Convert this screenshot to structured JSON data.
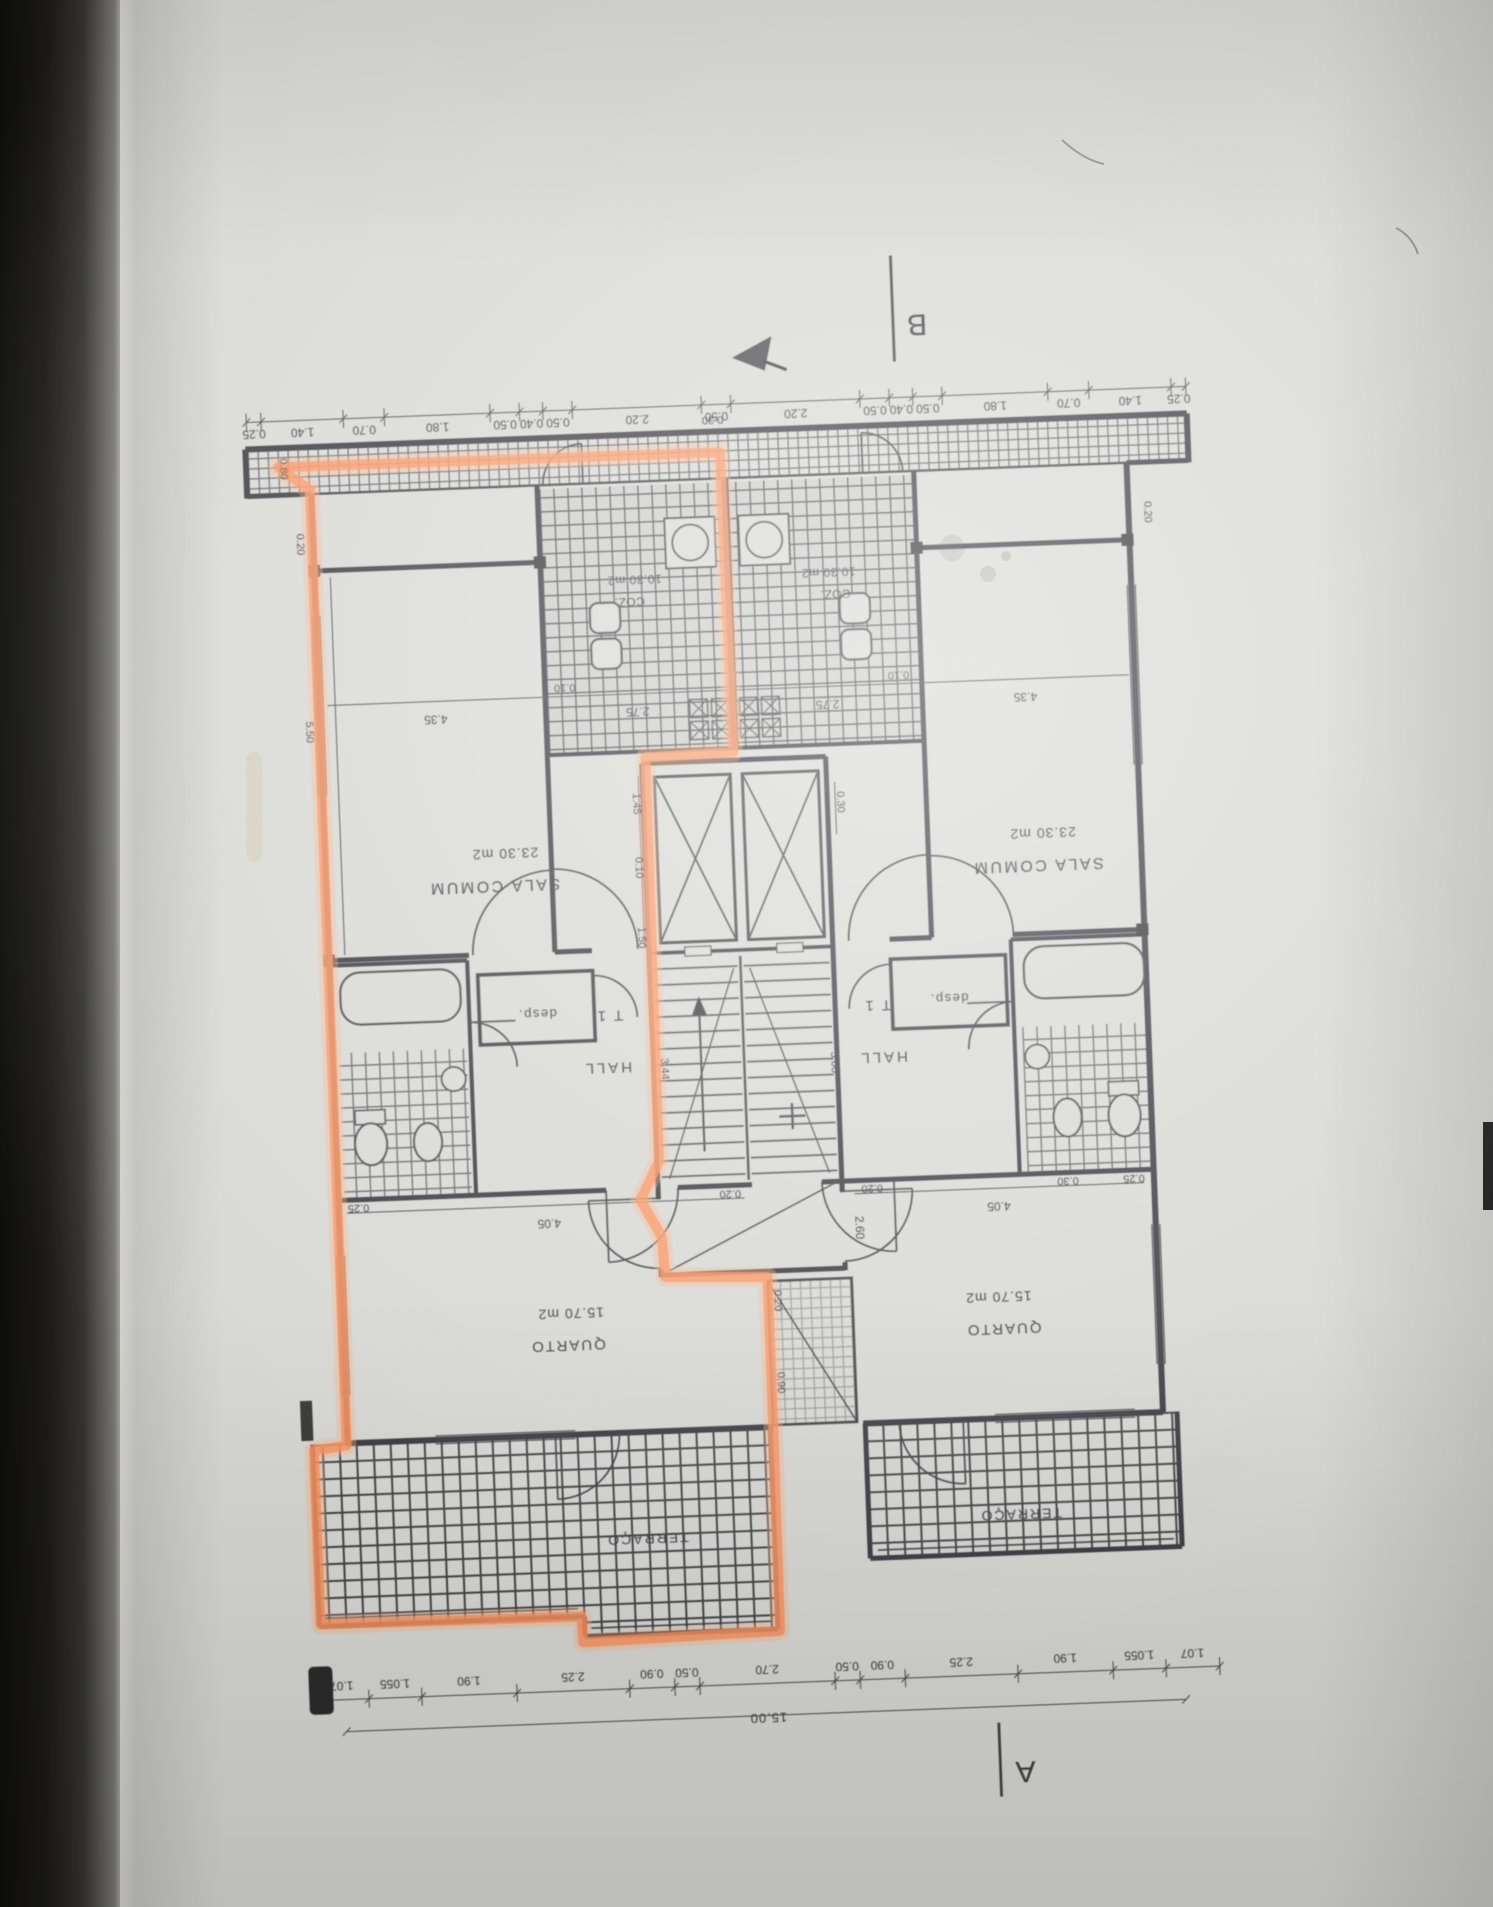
{
  "photo": {
    "description": "photographed architectural floor plan page, drawing upside-down, left apartment outlined with orange highlighter",
    "paper_color": "#d8d8d4",
    "ink_color": "#2b2b30",
    "highlight_color": "#ff8a50"
  },
  "plan": {
    "section_markers": {
      "a": "A",
      "b": "B"
    },
    "rooms": {
      "sala": {
        "name": "SALA COMUM",
        "area": "23.30 m2"
      },
      "cozinha": {
        "name": "COZ.",
        "area": "10.30 m2"
      },
      "quarto": {
        "name": "QUARTO",
        "area": "15.70 m2"
      },
      "hall": {
        "name": "HALL",
        "unit_type": "T 1"
      },
      "desp": {
        "name": "desp."
      },
      "terraco": {
        "name": "TERRAÇO"
      }
    },
    "dims_top": [
      "0.25",
      "1.40",
      "0.70",
      "1.80",
      "0.50",
      "0.40",
      "0.50",
      "2.20",
      "0.50",
      "2.20",
      "0.50",
      "0.40",
      "0.50",
      "1.80",
      "0.70",
      "1.40",
      "0.25"
    ],
    "dims_bottom": [
      "1.07",
      "1.055",
      "1.90",
      "2.25",
      "0.90",
      "0.50",
      "2.70",
      "0.50",
      "0.90",
      "2.25",
      "1.90",
      "1.055",
      "1.07"
    ],
    "dims_bottom_total": "15.00",
    "dim_labels": {
      "d080": "0.80",
      "d020": "0.20",
      "d550": "5.50",
      "d435": "4.35",
      "d010": "0.10",
      "d275": "2.75",
      "d145": "1.45",
      "d150": "1.50",
      "d030": "0.30",
      "d260": "2.60",
      "d300": "3.00",
      "d344": "3.44",
      "d405": "4.05",
      "d025": "0.25",
      "d090": "0.90"
    }
  }
}
